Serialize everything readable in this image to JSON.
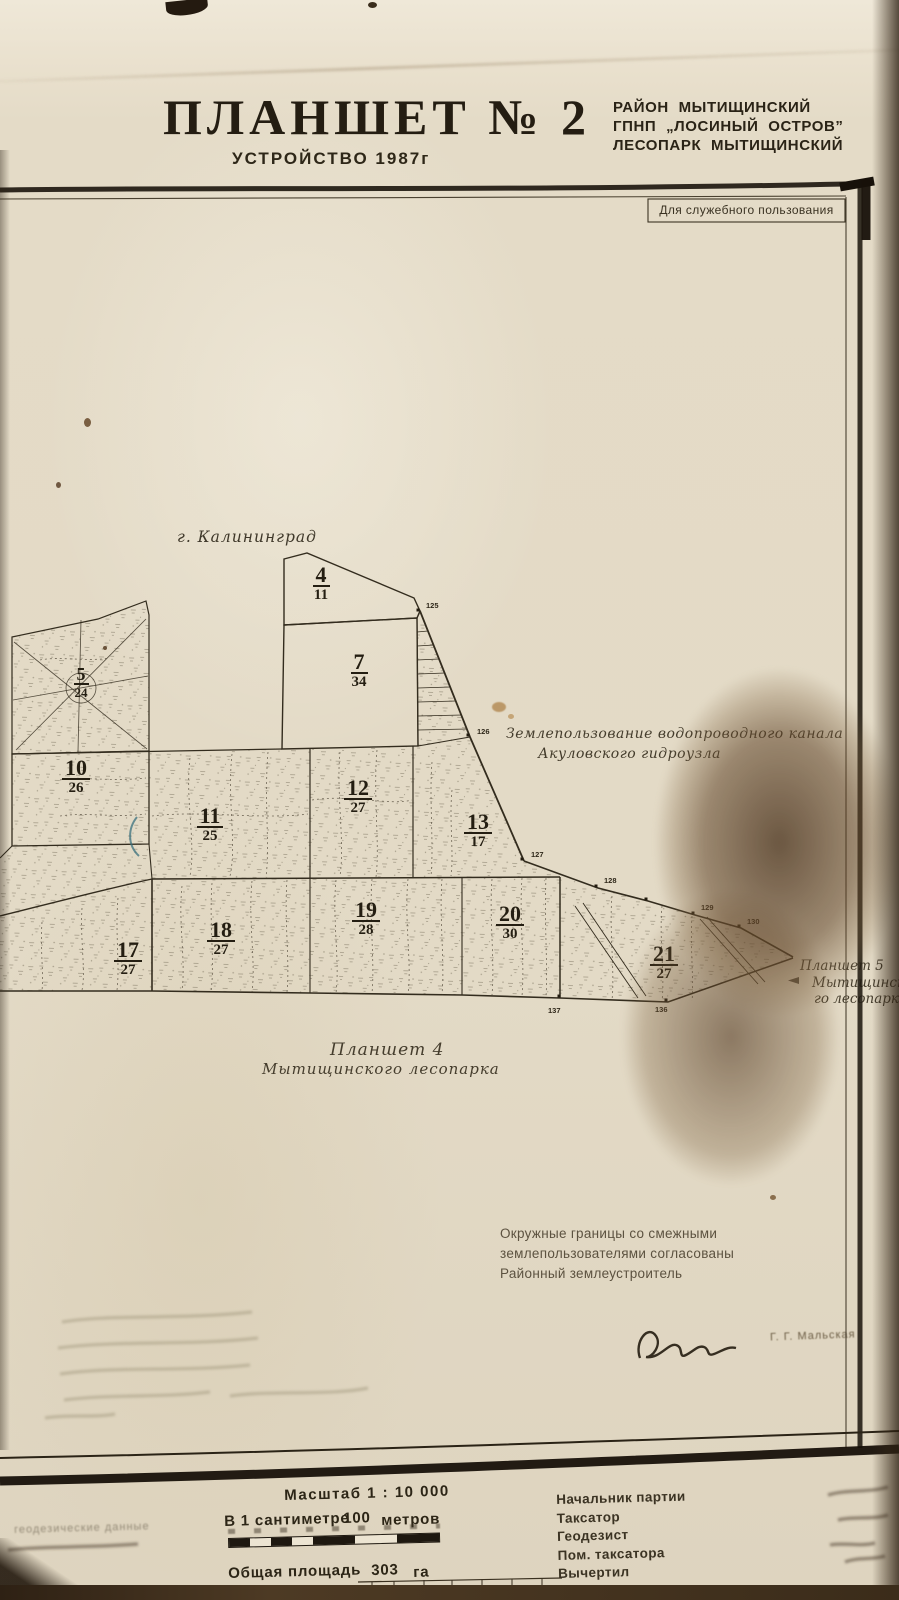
{
  "header": {
    "title": "ПЛАНШЕТ № 2",
    "subtitle": "УСТРОЙСТВО 1987г",
    "org_lines": [
      "РАЙОН МЫТИЩИНСКИЙ",
      "ГПНП „ЛОСИНЫЙ ОСТРОВ”",
      "ЛЕСОПАРК МЫТИЩИНСКИЙ"
    ],
    "classification": "Для служебного пользования"
  },
  "map": {
    "city_label": "г. Калининград",
    "landuse_note_line1": "Землепользование водопроводного канала",
    "landuse_note_line2": "Акуловского гидроузла",
    "neighbor_right": [
      "Планшет 5",
      "Мытищинско-",
      "го лесопарка"
    ],
    "neighbor_bottom": [
      "Планшет 4",
      "Мытищинского лесопарка"
    ],
    "quarters": [
      {
        "num": "4",
        "den": "11"
      },
      {
        "num": "7",
        "den": "34"
      },
      {
        "num": "5",
        "den": "24"
      },
      {
        "num": "10",
        "den": "26"
      },
      {
        "num": "11",
        "den": "25"
      },
      {
        "num": "12",
        "den": "27"
      },
      {
        "num": "13",
        "den": "17"
      },
      {
        "num": "17",
        "den": "27"
      },
      {
        "num": "18",
        "den": "27"
      },
      {
        "num": "19",
        "den": "28"
      },
      {
        "num": "20",
        "den": "30"
      },
      {
        "num": "21",
        "den": "27"
      }
    ],
    "boundary_points": [
      "125",
      "126",
      "127",
      "128",
      "129",
      "130",
      "136",
      "137"
    ]
  },
  "notes": {
    "agreement": [
      "Окружные границы со смежными",
      "землепользователями согласованы",
      "Районный землеустроитель"
    ],
    "signature_name": "Г. Г. Мальская"
  },
  "footer": {
    "scale_title": "Масштаб 1 : 10 000",
    "scale_sentence": [
      "В 1 сантиметре",
      "100",
      "метров"
    ],
    "area_label": "Общая площадь",
    "area_value": "303",
    "area_unit": "га",
    "staff": [
      "Начальник партии",
      "Таксатор",
      "Геодезист",
      "Пом. таксатора",
      "Вычертил"
    ],
    "faint_left_note": "геодезические данные"
  }
}
